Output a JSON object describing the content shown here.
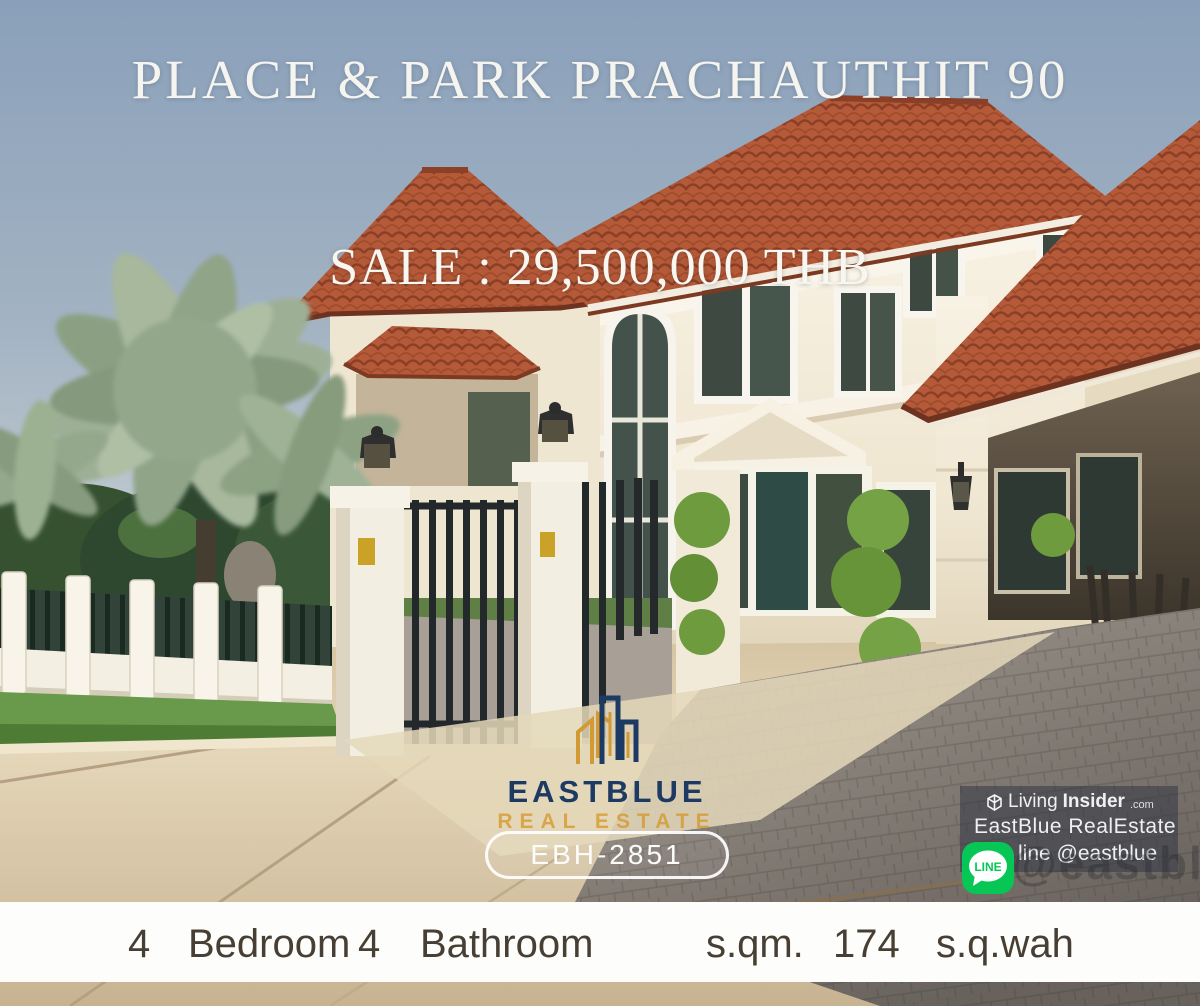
{
  "overlay": {
    "title": "PLACE & PARK PRACHAUTHIT 90",
    "price": "SALE : 29,500,000 THB"
  },
  "logo": {
    "brand": "EASTBLUE",
    "subtitle": "REAL ESTATE"
  },
  "listing_code": "EBH-2851",
  "watermark": {
    "living": "Living",
    "insider": "Insider",
    "dotcom": ".com",
    "agency": "EastBlue RealEstate",
    "line_badge": "LINE",
    "line_text": "line @eastblue",
    "ghost_handle": "@eastblue"
  },
  "details": {
    "bedroom_count": "4",
    "bedroom_label": "Bedroom",
    "bathroom_count": "4",
    "bathroom_label": "Bathroom",
    "sqm_label": "s.qm.",
    "area_value": "174",
    "wah_label": "s.q.wah"
  },
  "colors": {
    "brand_navy": "#1d3a63",
    "brand_gold": "#d6992e",
    "line_green": "#06c755",
    "roof_terracotta": "#b55a39",
    "sky_blue": "#8fa4bb"
  }
}
